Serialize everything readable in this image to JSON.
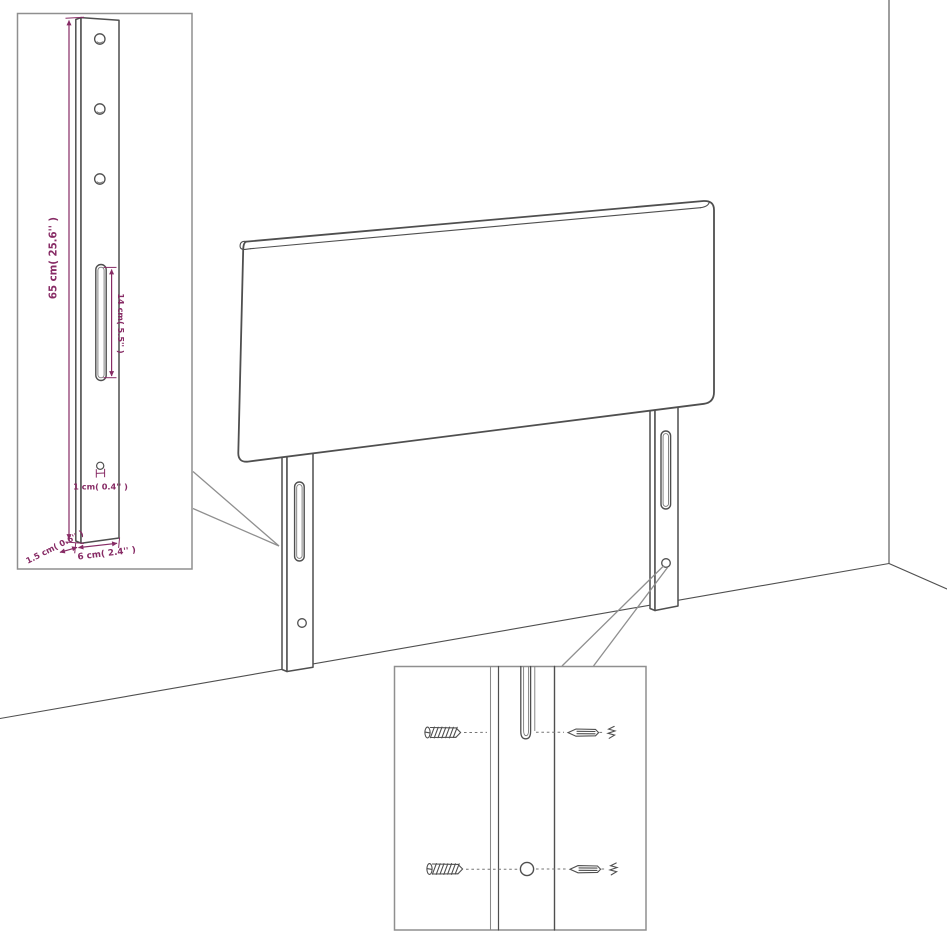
{
  "title": "headboard wall-mount assembly diagram",
  "colors": {
    "background": "#ffffff",
    "outline": "#4f4f4f",
    "dimension_accent": "#872b65",
    "callout_gray": "#8f8f8f"
  },
  "main_view": {
    "parts": [
      "headboard-panel",
      "left-mounting-leg",
      "right-mounting-leg",
      "room-corner",
      "floor-line"
    ]
  },
  "leg_detail_inset": {
    "labels": {
      "leg_height": "65 cm( 25.6'' )",
      "slot_length": "14 cm( 5.5'' )",
      "hole_diameter": "1 cm( 0.4'' )",
      "side_thickness": "1.5 cm( 0.6'' )",
      "leg_width": "6 cm( 2.4'' )"
    }
  },
  "mounting_detail_inset": {
    "parts": {
      "screw": "screw-icon",
      "wall_plug": "wall-plug-icon",
      "keyhole_slot": "keyhole-slot",
      "pilot_hole": "round-hole"
    }
  }
}
